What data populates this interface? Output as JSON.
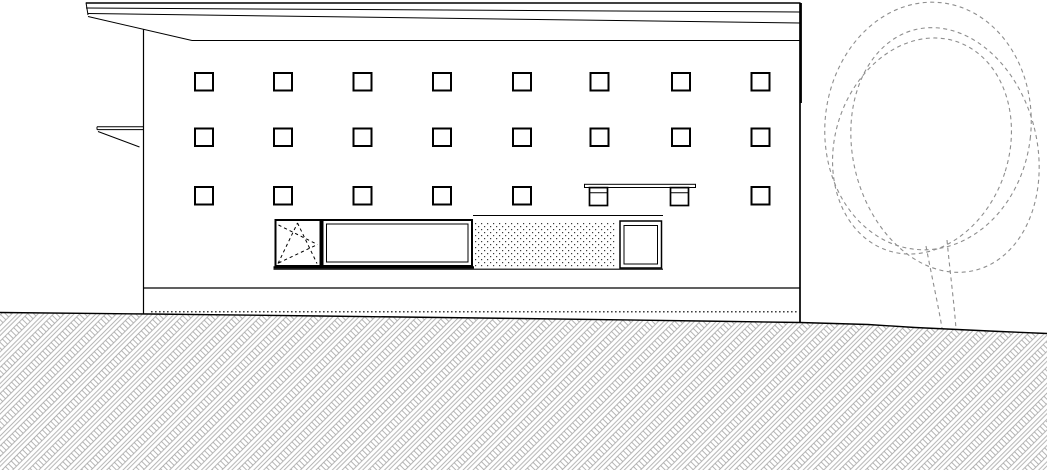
{
  "meta": {
    "type": "architectural-elevation-drawing",
    "description": "Side elevation: flat-roofed building with grid of square windows, shopfront band, bench, hatched ground and dashed tree"
  },
  "canvas": {
    "width": 1047,
    "height": 470,
    "background": "#ffffff",
    "line_color": "#000000",
    "hatch_color": "#a2a2a2",
    "tree_color": "#8e8e8e",
    "stipple_color": "#3a3a3a"
  },
  "window_grid": {
    "cols": [
      195,
      274,
      353.5,
      433,
      513,
      590.5,
      672,
      751.5
    ],
    "rows": [
      73,
      128.5,
      187
    ],
    "w": 18,
    "h": 17.5,
    "stroke_width": 2,
    "fill": "#ffffff",
    "skip": [
      [
        2,
        5
      ],
      [
        2,
        6
      ]
    ]
  },
  "groups": {
    "ground-hatch": {
      "elements": [
        {
          "t": "polygon",
          "points": "0,312.5 150,314 320,316 520,318.5 700,321 800,322.5 868,324.5 915,327.5 1000,331.5 1047,333.5 1047,470 0,470",
          "fill": "url(#hatch)",
          "style": "stroke:none"
        },
        {
          "t": "polyline",
          "points": "0,312.5 150,314 320,316 520,318.5 700,321 800,322.5 868,324.5 915,327.5 1000,331.5 1047,333.5",
          "style": "fill:none",
          "stroke-width": 1.4
        }
      ]
    },
    "building-outline": {
      "elements": [
        {
          "t": "line",
          "x1": 86,
          "y1": 3,
          "x2": 800,
          "y2": 3,
          "stroke-width": 1.6
        },
        {
          "t": "line",
          "x1": 86,
          "y1": 8,
          "x2": 800,
          "y2": 12,
          "stroke-width": 1
        },
        {
          "t": "line",
          "x1": 88,
          "y1": 13.5,
          "x2": 800,
          "y2": 23,
          "stroke-width": 1
        },
        {
          "t": "line",
          "x1": 86,
          "y1": 2.5,
          "x2": 88,
          "y2": 15,
          "stroke-width": 1
        },
        {
          "t": "line",
          "x1": 88,
          "y1": 16.5,
          "x2": 192,
          "y2": 40.5,
          "stroke-width": 1
        },
        {
          "t": "line",
          "x1": 192,
          "y1": 40.5,
          "x2": 800,
          "y2": 40.5,
          "stroke-width": 1.1
        },
        {
          "t": "line",
          "x1": 143.5,
          "y1": 29.5,
          "x2": 143.5,
          "y2": 313.5,
          "stroke-width": 1.2
        },
        {
          "t": "line",
          "x1": 800,
          "y1": 2.5,
          "x2": 800,
          "y2": 322.5,
          "stroke-width": 1.7
        },
        {
          "t": "line",
          "x1": 801.2,
          "y1": 3,
          "x2": 801.2,
          "y2": 103,
          "stroke-width": 1.4
        },
        {
          "t": "line",
          "x1": 143.5,
          "y1": 288,
          "x2": 800,
          "y2": 288,
          "stroke-width": 1.2
        },
        {
          "t": "line",
          "x1": 151,
          "y1": 311.8,
          "x2": 799,
          "y2": 311.8,
          "stroke-width": 1.2,
          "stroke-dasharray": "1.6 2.4"
        },
        {
          "t": "line",
          "x1": 97,
          "y1": 126.8,
          "x2": 143.5,
          "y2": 126.8,
          "stroke-width": 1
        },
        {
          "t": "line",
          "x1": 97,
          "y1": 129.6,
          "x2": 143.5,
          "y2": 129.6,
          "stroke-width": 1
        },
        {
          "t": "line",
          "x1": 97,
          "y1": 126.8,
          "x2": 97,
          "y2": 129.6,
          "stroke-width": 1
        },
        {
          "t": "line",
          "x1": 98,
          "y1": 131.5,
          "x2": 139.5,
          "y2": 147,
          "stroke-width": 1
        }
      ]
    },
    "bench": {
      "elements": [
        {
          "t": "rect",
          "x": 584.5,
          "y": 184.3,
          "width": 111,
          "height": 3.2,
          "fill": "#ffffff",
          "stroke-width": 1
        },
        {
          "t": "rect",
          "x": 589.5,
          "y": 187.6,
          "width": 18,
          "height": 17.9,
          "fill": "#ffffff",
          "stroke-width": 1.7
        },
        {
          "t": "rect",
          "x": 670.5,
          "y": 187.6,
          "width": 18,
          "height": 17.9,
          "fill": "#ffffff",
          "stroke-width": 1.7
        },
        {
          "t": "line",
          "x1": 589.5,
          "y1": 192.8,
          "x2": 607.5,
          "y2": 192.8,
          "stroke-width": 1
        },
        {
          "t": "line",
          "x1": 670.5,
          "y1": 192.8,
          "x2": 688.5,
          "y2": 192.8,
          "stroke-width": 1
        }
      ]
    },
    "shopfront": {
      "elements": [
        {
          "t": "line",
          "x1": 473,
          "y1": 215.5,
          "x2": 663,
          "y2": 215.5,
          "stroke-width": 1
        },
        {
          "t": "rect",
          "x": 474.5,
          "y": 222.5,
          "width": 141,
          "height": 45.5,
          "fill": "url(#stipple)",
          "style": "stroke:none"
        },
        {
          "t": "rect",
          "x": 275.5,
          "y": 220,
          "width": 45,
          "height": 46,
          "fill": "#ffffff",
          "stroke-width": 2
        },
        {
          "t": "line",
          "x1": 278,
          "y1": 263.5,
          "x2": 297.5,
          "y2": 223,
          "stroke-width": 1,
          "stroke-dasharray": "3.2 3"
        },
        {
          "t": "line",
          "x1": 297.5,
          "y1": 223,
          "x2": 317,
          "y2": 263.5,
          "stroke-width": 1,
          "stroke-dasharray": "3.2 3"
        },
        {
          "t": "line",
          "x1": 278.5,
          "y1": 225,
          "x2": 317.5,
          "y2": 244.5,
          "stroke-width": 1,
          "stroke-dasharray": "3.2 3"
        },
        {
          "t": "line",
          "x1": 278.5,
          "y1": 263,
          "x2": 317.5,
          "y2": 244.5,
          "stroke-width": 1,
          "stroke-dasharray": "3.2 3"
        },
        {
          "t": "rect",
          "x": 322.5,
          "y": 220,
          "width": 149.5,
          "height": 46,
          "fill": "#ffffff",
          "stroke-width": 2
        },
        {
          "t": "rect",
          "x": 326.5,
          "y": 224,
          "width": 141.5,
          "height": 38,
          "fill": "none",
          "stroke-width": 1
        },
        {
          "t": "rect",
          "x": 620,
          "y": 221,
          "width": 41.5,
          "height": 47,
          "fill": "#ffffff",
          "stroke-width": 1.5
        },
        {
          "t": "rect",
          "x": 624,
          "y": 225.5,
          "width": 33.5,
          "height": 38.5,
          "fill": "none",
          "stroke-width": 1
        },
        {
          "t": "line",
          "x1": 273.5,
          "y1": 267.4,
          "x2": 474,
          "y2": 267.4,
          "stroke-width": 2.4
        },
        {
          "t": "line",
          "x1": 273.5,
          "y1": 269.2,
          "x2": 663,
          "y2": 269.2,
          "stroke-width": 1.2
        }
      ]
    },
    "tree": {
      "elements": [
        {
          "t": "ellipse",
          "cx": 928,
          "cy": 126,
          "rx": 103,
          "ry": 124,
          "transform": "rotate(6 928 126)"
        },
        {
          "t": "ellipse",
          "cx": 945,
          "cy": 150,
          "rx": 92,
          "ry": 124,
          "transform": "rotate(-14 945 150)"
        },
        {
          "t": "ellipse",
          "cx": 922,
          "cy": 146,
          "rx": 87,
          "ry": 110,
          "transform": "rotate(18 922 146)"
        },
        {
          "t": "path",
          "d": "M926,246 C932,278 938,304 942,328"
        },
        {
          "t": "path",
          "d": "M947,240 C950,272 954,302 956,329"
        }
      ]
    }
  }
}
